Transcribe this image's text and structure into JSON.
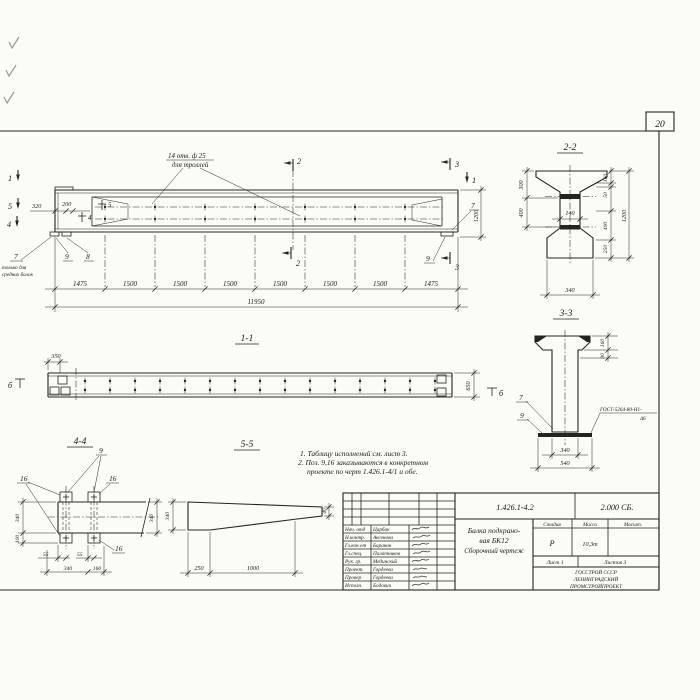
{
  "sheet": {
    "page_number": "20"
  },
  "main_view": {
    "holes_label_1": "14 отв. ф 25",
    "holes_label_2": "для троллей",
    "dim_320": "320",
    "dim_200": "200",
    "seg_dims": [
      "1475",
      "1500",
      "1500",
      "1500",
      "1500",
      "1500",
      "1500",
      "1475"
    ],
    "dim_total": "11950",
    "dim_height": "1200",
    "marker_1": "1",
    "marker_2": "2",
    "marker_3": "3",
    "marker_4": "4",
    "marker_5": "5",
    "pos_7": "7",
    "pos_8": "8",
    "pos_9": "9",
    "note_line1": "только для",
    "note_line2": "средних балок"
  },
  "view_1_1": {
    "title": "1-1",
    "dim_350": "350",
    "dim_650": "650",
    "marker_b": "б"
  },
  "view_2_2": {
    "title": "2-2",
    "dim_300": "300",
    "dim_400_left": "400",
    "dim_140": "140",
    "dim_160": "160",
    "dim_50": "50",
    "dim_1200": "1200",
    "dim_400_right": "400",
    "dim_250": "250",
    "dim_340": "340"
  },
  "view_3_3": {
    "title": "3-3",
    "dim_160": "160",
    "dim_30": "30",
    "pos_7": "7",
    "pos_9": "9",
    "weld_line1": "ГОСТ-5264-80-Н1-",
    "weld_line2": "Δ6",
    "dim_340": "340",
    "dim_540": "540"
  },
  "view_4_4": {
    "title": "4-4",
    "pos_9": "9",
    "pos_16": "16",
    "dim_340_side": "340",
    "dim_100": "100",
    "dim_55": "55",
    "dim_340_bottom": "340",
    "dim_160": "160",
    "dim_340_right": "340"
  },
  "view_5_5": {
    "title": "5-5",
    "dim_340": "340",
    "dim_250": "250",
    "dim_1000": "1000",
    "dim_40": "40"
  },
  "notes": {
    "line1": "1. Таблицу исполнений см. лист 3.",
    "line2": "2. Поз. 9,16 заказываются в конкретном",
    "line3": "проекте по черт 1.426.1-4/1 и обе."
  },
  "title_block": {
    "doc_number": "1.426.1-4.2",
    "doc_code": "2.000 СБ.",
    "title_line1": "Балка подкрано-",
    "title_line2": "вая БК12",
    "title_line3": "Сборочный чертеж",
    "col_stage": "Стадия",
    "col_mass": "Масса",
    "col_scale": "Масшт.",
    "stage": "Р",
    "mass": "10,3т",
    "sheet_no": "Лист 1",
    "sheets_total": "Листов 3",
    "org_line1": "ГОССТРОЙ СССР",
    "org_line2": "ЛЕНИНГРАДСКИЙ",
    "org_line3": "ПРОМСТРОЙПРОЕКТ",
    "rows": [
      {
        "role": "Нач. отд",
        "name": "Царбак"
      },
      {
        "role": "Н.контр.",
        "name": "Аксенова"
      },
      {
        "role": "Гл.кон.от",
        "name": "Баранов"
      },
      {
        "role": "Гл.спец.",
        "name": "Палатников"
      },
      {
        "role": "Рук. гр.",
        "name": "Мединский"
      },
      {
        "role": "Проект.",
        "name": "Гордеева"
      },
      {
        "role": "Провер.",
        "name": "Гордеева"
      },
      {
        "role": "Исполн.",
        "name": "Бодович"
      }
    ]
  }
}
